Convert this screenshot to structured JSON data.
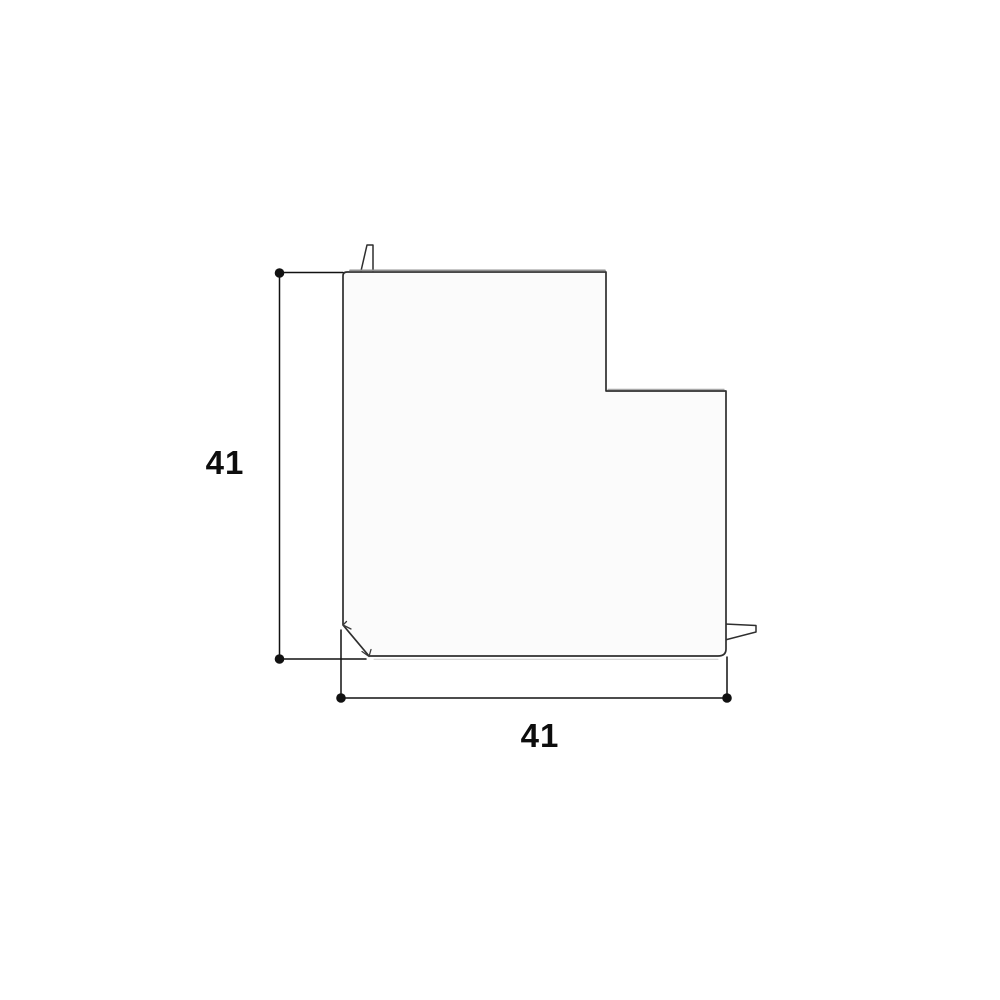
{
  "drawing": {
    "kind": "technical-dimension-drawing",
    "part_shape": "flat-angle (L-shaped) fitting, plan view, with top locating tab, right locating tab and chamfered inner corner",
    "dimensions": {
      "height": {
        "value": "41"
      },
      "width": {
        "value": "41"
      }
    },
    "colors": {
      "background": "#ffffff",
      "outline": "#2e2e2e",
      "part_fill": "#fbfbfb",
      "dimension_line": "#111111",
      "edge_shadow": "#8f8f8f"
    }
  }
}
